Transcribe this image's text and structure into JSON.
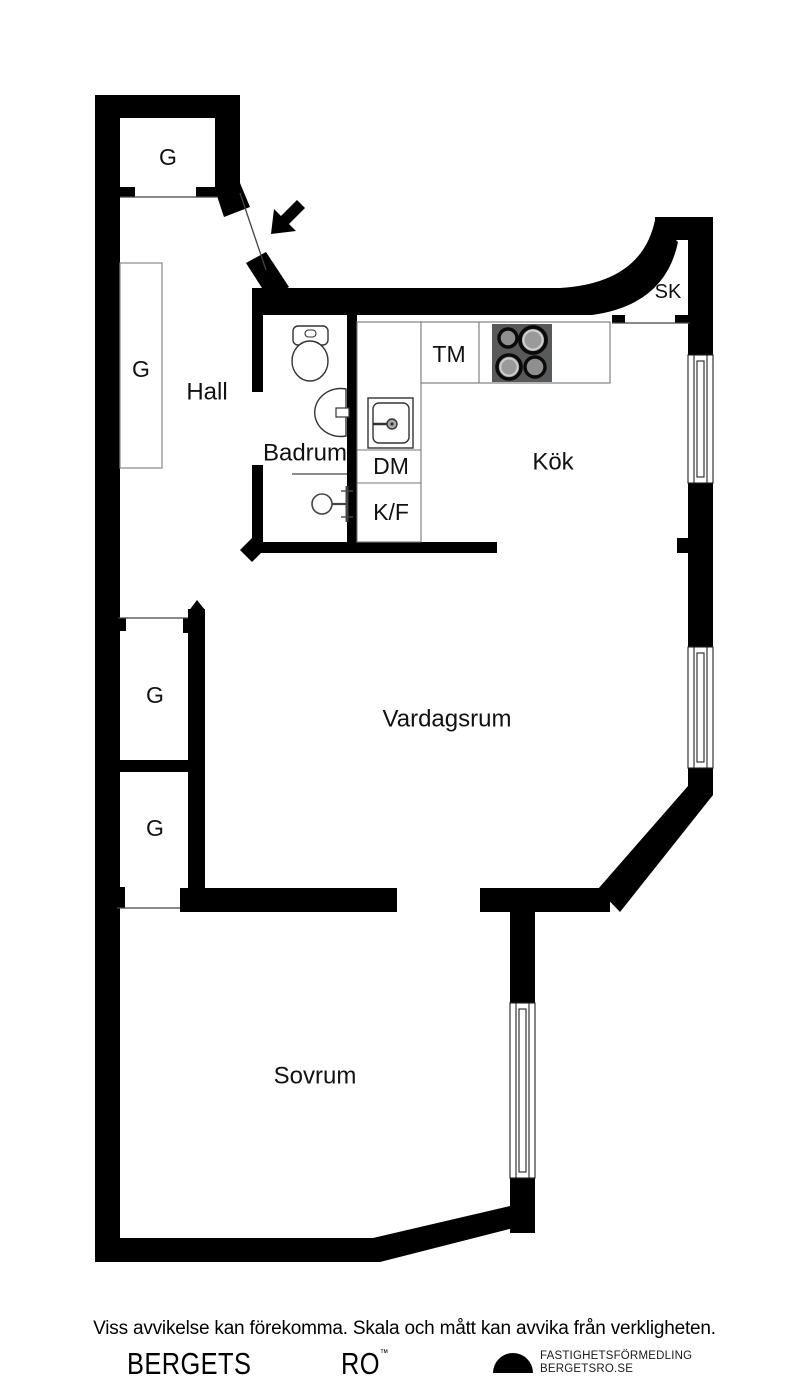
{
  "plan": {
    "room_labels": {
      "hall": "Hall",
      "bathroom": "Badrum",
      "kitchen": "Kök",
      "living_room": "Vardagsrum",
      "bedroom": "Sovrum"
    },
    "feature_labels": {
      "wardrobe": "G",
      "washing_machine": "TM",
      "dishwasher": "DM",
      "fridge_freezer": "K/F",
      "cabinet": "SK"
    }
  },
  "footer": {
    "disclaimer": "Viss avvikelse kan förekomma. Skala och mått kan avvika från verkligheten.",
    "brand_word1": "BERGETS",
    "brand_word2": "RO",
    "trademark_symbol": "™",
    "agency_line1": "FASTIGHETSFÖRMEDLING",
    "agency_line2": "BERGETSRO.SE"
  },
  "colors": {
    "wall": "#000000",
    "background": "#ffffff",
    "stove_panel": "#58595b",
    "burner_fill": "#8f8f8f",
    "burner_ring_light": "#cfcfcf"
  }
}
